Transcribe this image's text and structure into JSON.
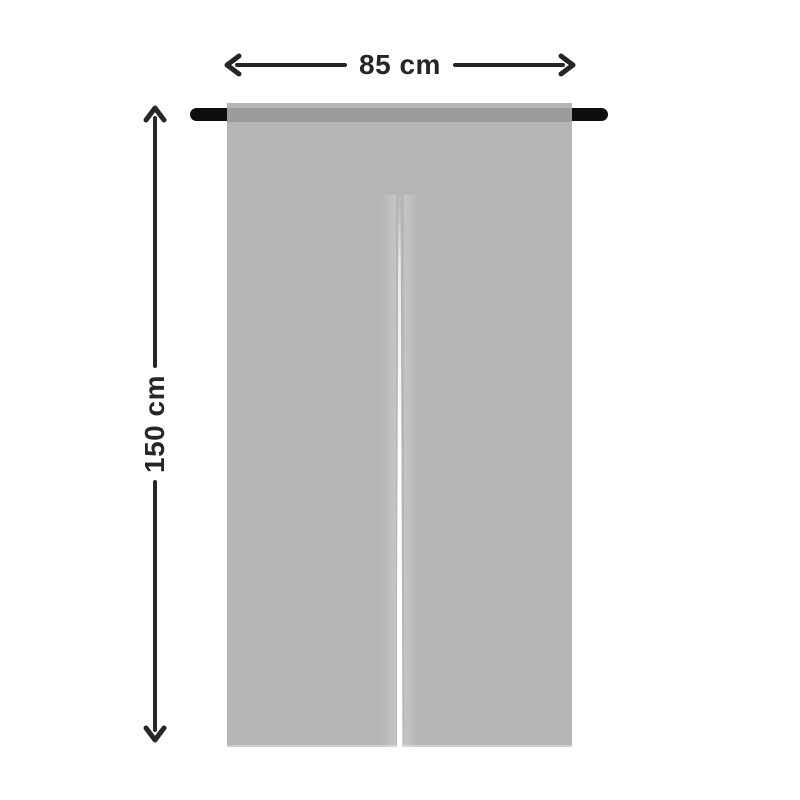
{
  "diagram": {
    "name": "Noren curtain size diagram",
    "dimensions": {
      "width": {
        "label": "85 cm"
      },
      "height": {
        "label": "150 cm"
      }
    },
    "colors": {
      "background": "#ffffff",
      "curtain": "#b5b5b5",
      "curtain_rod_band": "#9c9c9c",
      "rod": "#0e0e0e",
      "dimension_line": "#262626",
      "split_gap": "#ffffff"
    },
    "icons": {
      "arrow_left": "chevron-left",
      "arrow_right": "chevron-right",
      "arrow_up": "chevron-up",
      "arrow_down": "chevron-down"
    }
  }
}
